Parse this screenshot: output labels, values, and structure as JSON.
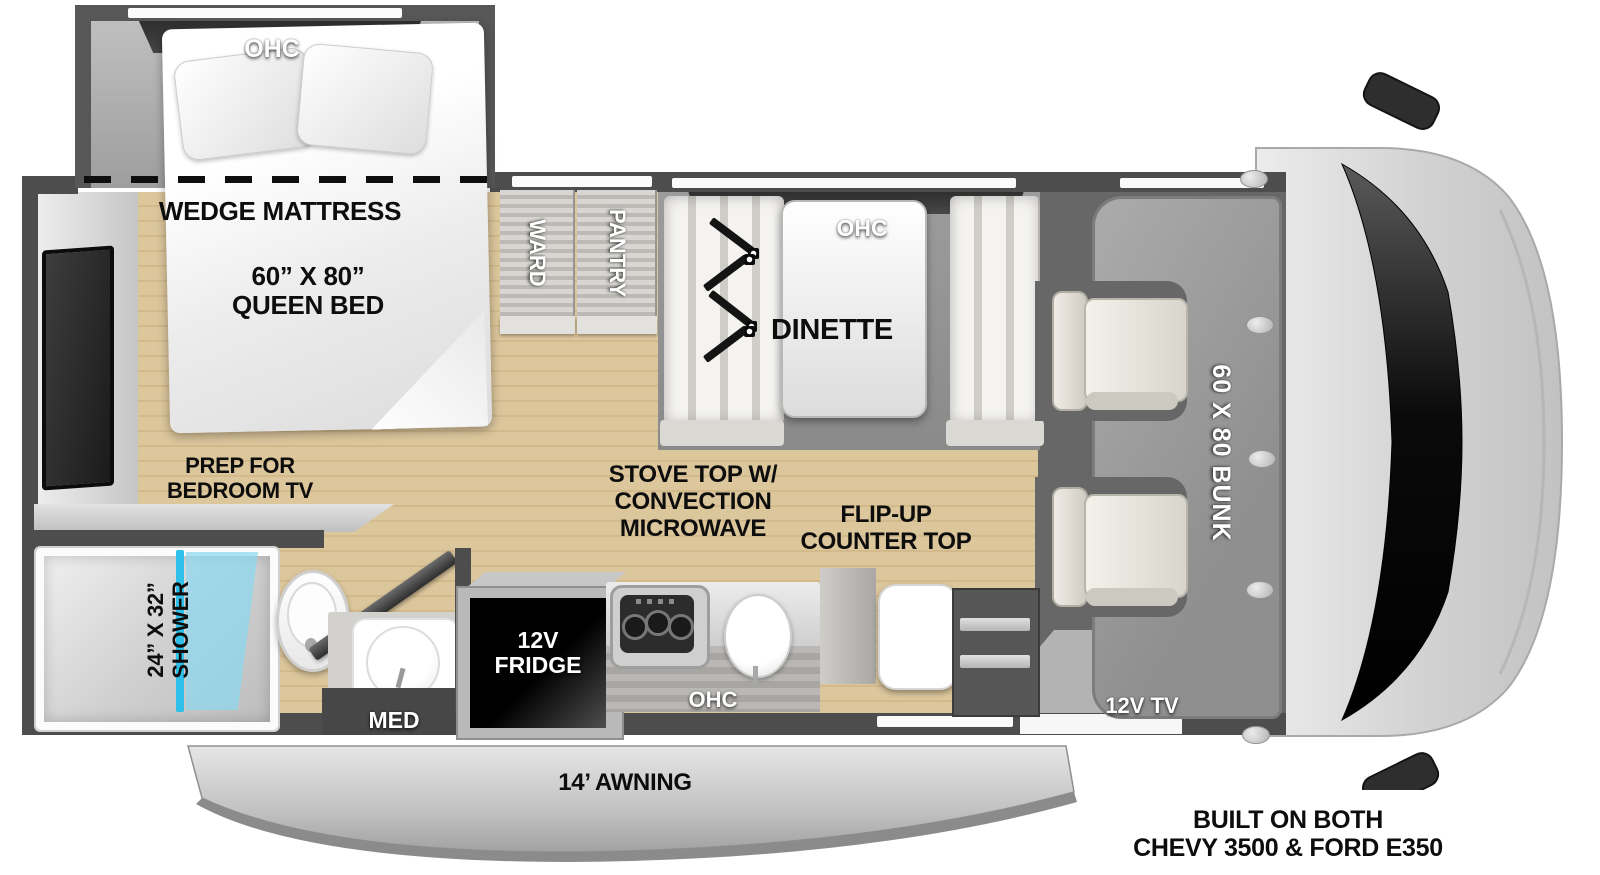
{
  "labels": {
    "bedroom_ohc": "OHC",
    "wedge_mattress": "WEDGE MATTRESS",
    "queen_bed": "60” X 80”\nQUEEN BED",
    "prep_tv": "PREP FOR\nBEDROOM TV",
    "ward": "WARD",
    "pantry": "PANTRY",
    "dinette_ohc": "OHC",
    "dinette": "DINETTE",
    "bunk": "60 X 80 BUNK",
    "cab_tv": "12V TV",
    "shower": "24” X 32”\nSHOWER",
    "med": "MED",
    "fridge": "12V\nFRIDGE",
    "stove": "STOVE TOP W/\nCONVECTION\nMICROWAVE",
    "flip_up": "FLIP-UP\nCOUNTER TOP",
    "kitchen_ohc": "OHC",
    "awning": "14’ AWNING",
    "chassis": "BUILT ON BOTH\nCHEVY 3500 & FORD E350"
  },
  "colors": {
    "wall": "#4d4d4d",
    "floor_wood": "#d9c196",
    "slide_floor": "#a9a9a9",
    "under_bunk": "#676767",
    "bunk": "#9c9c9c",
    "shower_glass": "#2fc0ea",
    "cab_body": "#d6d6d6",
    "windshield": "#0a0a0a",
    "awning_gray": "#c7c7c7",
    "label_black": "#0d0d0d",
    "label_white": "#ffffff"
  }
}
